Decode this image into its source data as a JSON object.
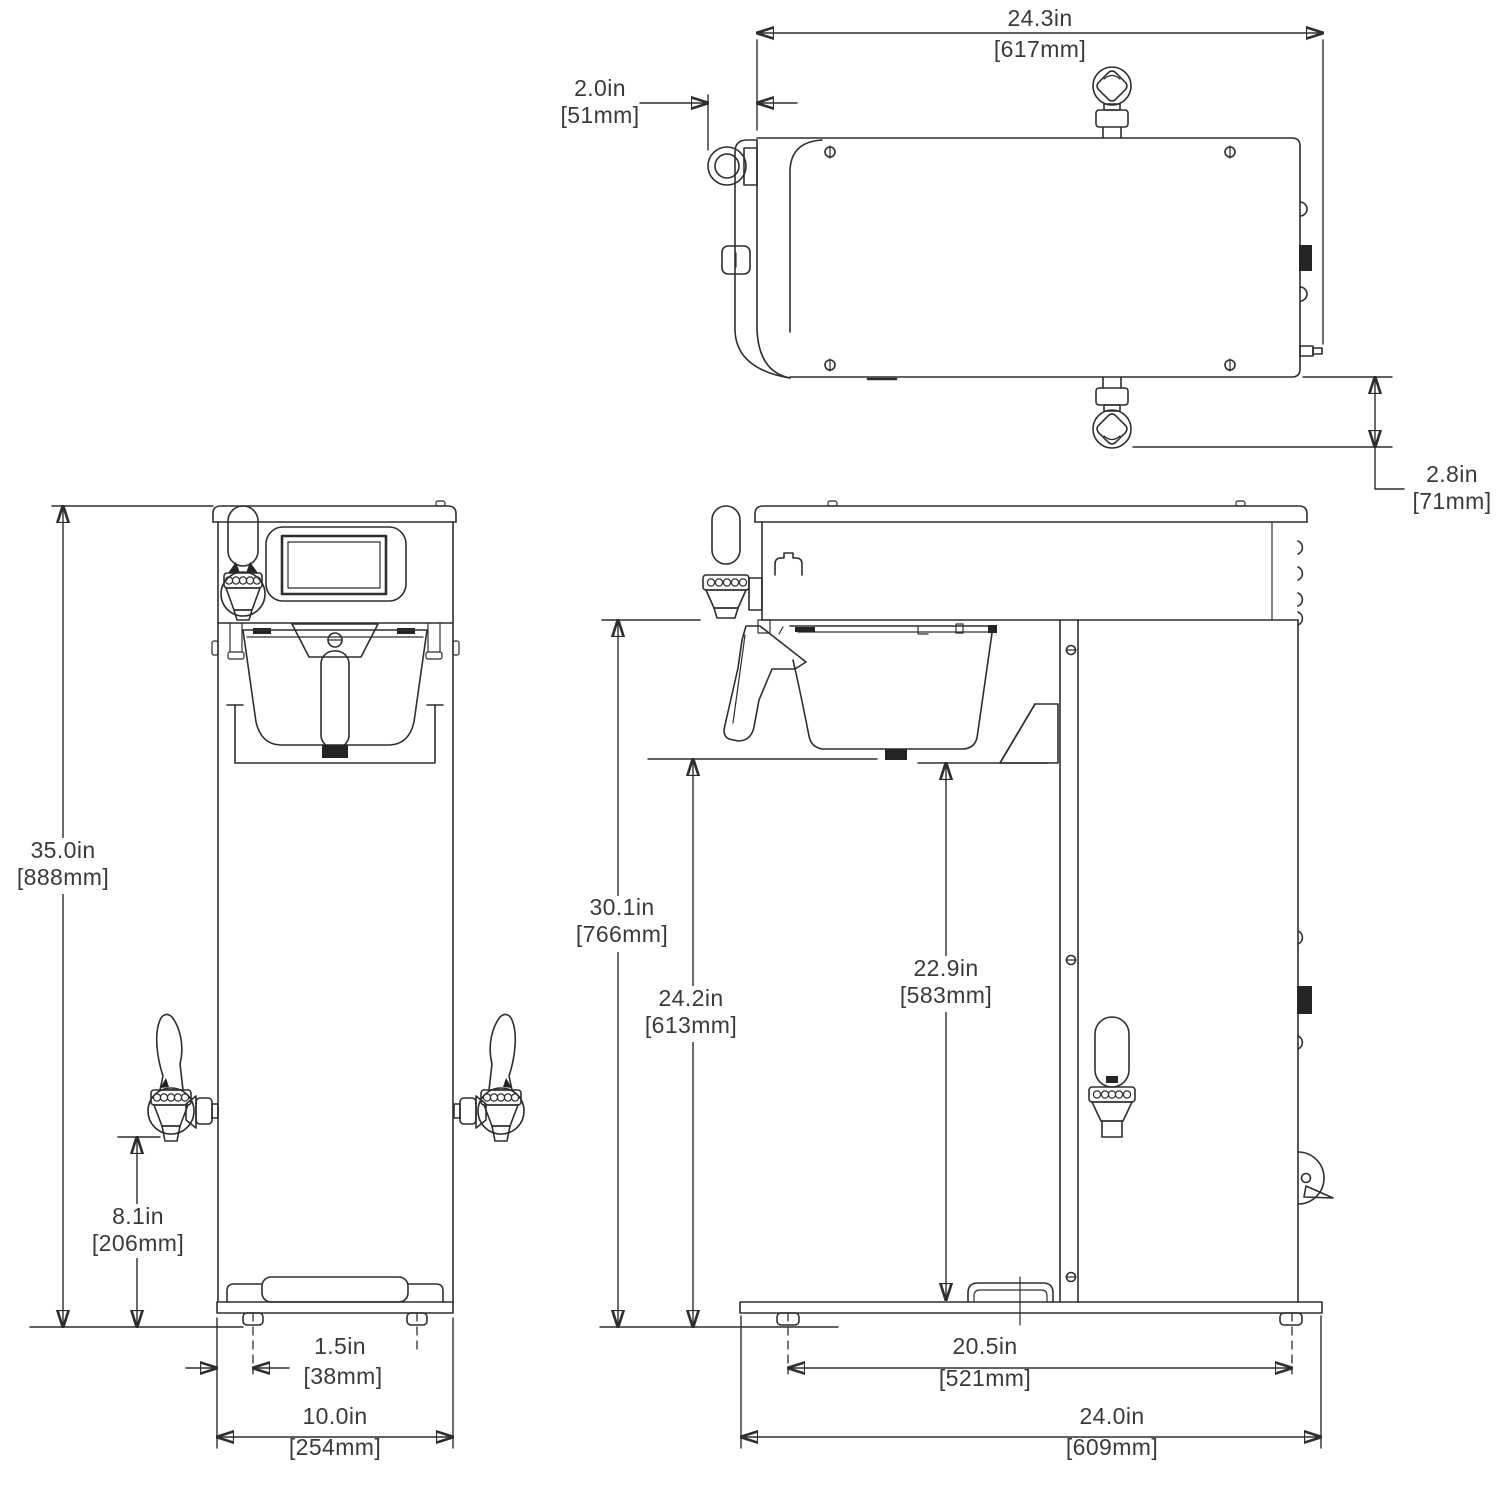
{
  "colors": {
    "background": "#ffffff",
    "line": "#2e2e2e",
    "text": "#3a3a3a"
  },
  "dimensions": {
    "top_depth": {
      "in": "24.3in",
      "mm": "[617mm]"
    },
    "handle_clearance": {
      "in": "2.0in",
      "mm": "[51mm]"
    },
    "rear_fitting_offset": {
      "in": "2.8in",
      "mm": "[71mm]"
    },
    "overall_height": {
      "in": "35.0in",
      "mm": "[888mm]"
    },
    "faucet_height": {
      "in": "8.1in",
      "mm": "[206mm]"
    },
    "foot_inset": {
      "in": "1.5in",
      "mm": "[38mm]"
    },
    "base_width": {
      "in": "10.0in",
      "mm": "[254mm]"
    },
    "dispense_clearance": {
      "in": "30.1in",
      "mm": "[766mm]"
    },
    "funnel_clearance": {
      "in": "24.2in",
      "mm": "[613mm]"
    },
    "shelf_clearance": {
      "in": "22.9in",
      "mm": "[583mm]"
    },
    "foot_span": {
      "in": "20.5in",
      "mm": "[521mm]"
    },
    "base_depth": {
      "in": "24.0in",
      "mm": "[609mm]"
    }
  }
}
